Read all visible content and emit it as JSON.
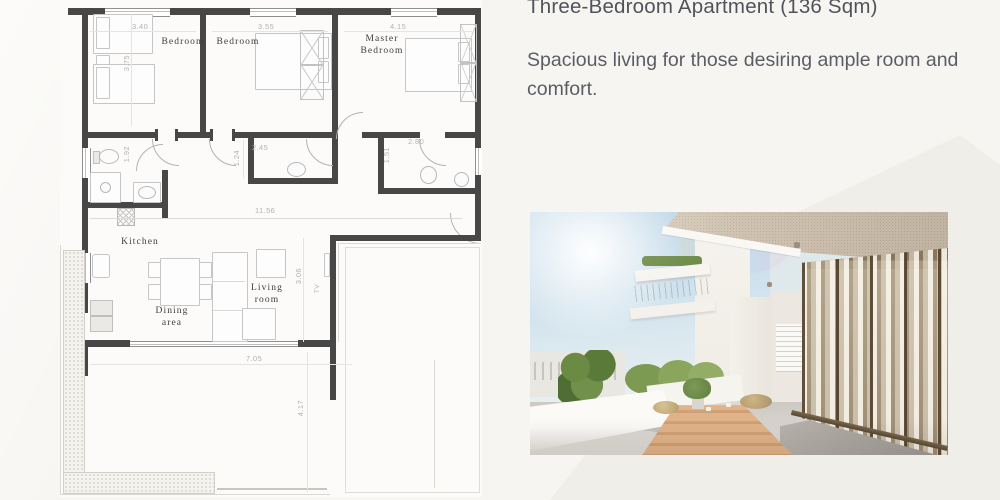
{
  "colors": {
    "page_bg": "#f7f5f1",
    "title_text": "#50545a",
    "body_text": "#5a5e64",
    "plan_wall": "#474747"
  },
  "right_panel": {
    "title": "Three-Bedroom Apartment (136 Sqm)",
    "description": "Spacious living for those desiring ample room and comfort."
  },
  "floor_plan": {
    "labels": {
      "bedroom1": "Bedroom",
      "bedroom2": "Bedroom",
      "master": "Master Bedroom",
      "kitchen": "Kitchen",
      "dining": "Dining area",
      "living": "Living room",
      "tv": "TV"
    },
    "dims": {
      "bedroom1_width": "3.40",
      "bedroom1_depth": "3.75",
      "bedroom2_width": "3.55",
      "master_width": "4.15",
      "bath1_depth": "1.92",
      "bath2_depth": "1.24",
      "bath2_width": "2.45",
      "bath3_width": "2.80",
      "bath3_depth": "1.51",
      "corridor_length": "11.56",
      "living_depth": "3.06",
      "terrace_width": "7.05",
      "terrace_depth": "4.17"
    }
  },
  "photo": {
    "name": "terrace-render"
  }
}
